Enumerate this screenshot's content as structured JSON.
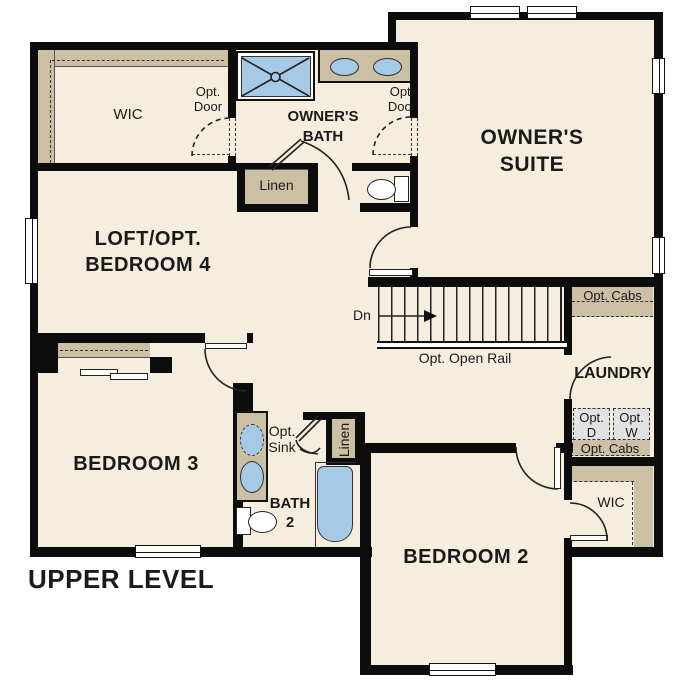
{
  "title": "UPPER LEVEL",
  "rooms": {
    "owners_suite": {
      "line1": "OWNER'S",
      "line2": "SUITE"
    },
    "owners_bath": {
      "line1": "OWNER'S",
      "line2": "BATH"
    },
    "owners_wic": {
      "label": "WIC"
    },
    "loft": {
      "line1": "LOFT/OPT.",
      "line2": "BEDROOM 4"
    },
    "bedroom3": {
      "label": "BEDROOM 3"
    },
    "bath2": {
      "line1": "BATH",
      "line2": "2"
    },
    "bedroom2": {
      "label": "BEDROOM 2"
    },
    "bedroom2_wic": {
      "label": "WIC"
    },
    "laundry": {
      "label": "LAUNDRY"
    }
  },
  "annotations": {
    "opt_door_wic": {
      "line1": "Opt.",
      "line2": "Door"
    },
    "opt_door_bath": {
      "line1": "Opt.",
      "line2": "Door"
    },
    "linen_hall": {
      "label": "Linen"
    },
    "linen_bath2": {
      "label": "Linen"
    },
    "opt_sink": {
      "line1": "Opt.",
      "line2": "Sink"
    },
    "opt_cabs_top": {
      "label": "Opt. Cabs"
    },
    "opt_cabs_bottom": {
      "label": "Opt. Cabs"
    },
    "opt_dryer": {
      "line1": "Opt.",
      "line2": "D"
    },
    "opt_washer": {
      "line1": "Opt.",
      "line2": "W"
    },
    "stairs": {
      "down": "Dn",
      "rail": "Opt. Open Rail"
    }
  },
  "colors": {
    "wall": "#0c0c0c",
    "floor": "#f5edde",
    "cabinet": "#cbbfa4",
    "fixture": "#a6c9e5",
    "appliance": "#e2e2e2"
  }
}
